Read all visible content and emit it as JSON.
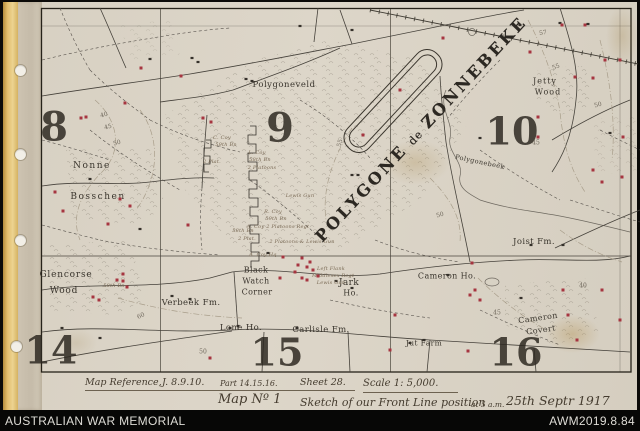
{
  "colors": {
    "post_red": "#a63540",
    "paper": "#d9d2c5",
    "ink": "#3a352d",
    "binding_yellow": "#e2bd6c"
  },
  "footer": {
    "org": "AUSTRALIAN WAR MEMORIAL",
    "id": "AWM2019.8.84"
  },
  "caption": {
    "ref_label": "Map Reference,",
    "ref_value": "J. 8.9.10.",
    "part": "Part 14.15.16.",
    "sheet": "Sheet 28.",
    "scale": "Scale 1: 5,000.",
    "map_no": "Map Nº 1",
    "title": "Sketch of our Front Line position",
    "at": "at 5 a.m.",
    "date": "25th Septr 1917"
  },
  "map": {
    "title": {
      "word1": "POLYGONE",
      "word2": "de",
      "word3": "ZONNEBEKE"
    },
    "grid_numbers": [
      {
        "t": "8",
        "x": 54,
        "y": 127,
        "s": 40
      },
      {
        "t": "9",
        "x": 280,
        "y": 128,
        "s": 40
      },
      {
        "t": "10",
        "x": 512,
        "y": 131,
        "s": 38
      },
      {
        "t": "14",
        "x": 51,
        "y": 350,
        "s": 38
      },
      {
        "t": "15",
        "x": 277,
        "y": 352,
        "s": 38
      },
      {
        "t": "16",
        "x": 516,
        "y": 352,
        "s": 38
      }
    ],
    "place_labels": [
      {
        "t": "Polygoneveld",
        "x": 284,
        "y": 85,
        "s": 8.5,
        "ls": 0.5
      },
      {
        "t": "Jetty",
        "x": 545,
        "y": 81,
        "s": 8,
        "ls": 1
      },
      {
        "t": "Wood",
        "x": 548,
        "y": 92,
        "s": 8,
        "ls": 1
      },
      {
        "t": "Nonne",
        "x": 92,
        "y": 166,
        "s": 9,
        "ls": 1.5
      },
      {
        "t": "Bosschen",
        "x": 98,
        "y": 197,
        "s": 9,
        "ls": 1.5
      },
      {
        "t": "Glencorse",
        "x": 66,
        "y": 275,
        "s": 9,
        "ls": 0.8
      },
      {
        "t": "Wood",
        "x": 64,
        "y": 291,
        "s": 9,
        "ls": 0.8
      },
      {
        "t": "Black",
        "x": 256,
        "y": 270,
        "s": 8
      },
      {
        "t": "Watch",
        "x": 256,
        "y": 281,
        "s": 8
      },
      {
        "t": "Corner",
        "x": 257,
        "y": 292,
        "s": 8
      },
      {
        "t": "Jark",
        "x": 349,
        "y": 283,
        "s": 9
      },
      {
        "t": "Ho.",
        "x": 351,
        "y": 293,
        "s": 8
      },
      {
        "t": "Verbeek Fm.",
        "x": 191,
        "y": 303,
        "s": 8.5
      },
      {
        "t": "Lone Ho.",
        "x": 241,
        "y": 328,
        "s": 8.5
      },
      {
        "t": "Carlisle Fm.",
        "x": 321,
        "y": 330,
        "s": 8.5
      },
      {
        "t": "Jut Farm",
        "x": 424,
        "y": 343,
        "s": 7.5
      },
      {
        "t": "Joist Fm.",
        "x": 534,
        "y": 242,
        "s": 8.5
      },
      {
        "t": "Cameron Ho.",
        "x": 447,
        "y": 276,
        "s": 8
      },
      {
        "t": "Cameron",
        "x": 538,
        "y": 318,
        "s": 8,
        "r": -8
      },
      {
        "t": "Covert",
        "x": 541,
        "y": 330,
        "s": 8,
        "r": -8
      },
      {
        "t": "Polygonebeek",
        "x": 480,
        "y": 162,
        "s": 6.5,
        "r": 12
      }
    ],
    "contour_labels": [
      {
        "t": "40",
        "x": 104,
        "y": 115,
        "r": -15
      },
      {
        "t": "45",
        "x": 108,
        "y": 127,
        "r": -15
      },
      {
        "t": "50",
        "x": 117,
        "y": 143,
        "r": -15
      },
      {
        "t": "57",
        "x": 543,
        "y": 33,
        "r": -10
      },
      {
        "t": "55",
        "x": 556,
        "y": 67,
        "r": -20
      },
      {
        "t": "50",
        "x": 598,
        "y": 105,
        "r": -15
      },
      {
        "t": "45",
        "x": 536,
        "y": 143
      },
      {
        "t": "55",
        "x": 340,
        "y": 143,
        "r": -75
      },
      {
        "t": "60",
        "x": 141,
        "y": 316,
        "r": -25
      },
      {
        "t": "50",
        "x": 203,
        "y": 352
      },
      {
        "t": "40",
        "x": 583,
        "y": 286
      },
      {
        "t": "45",
        "x": 497,
        "y": 313
      },
      {
        "t": "50",
        "x": 440,
        "y": 215,
        "r": -15
      }
    ],
    "annotations": [
      {
        "t": "C. Coy",
        "x": 222,
        "y": 138
      },
      {
        "t": "59th Bn",
        "x": 226,
        "y": 145
      },
      {
        "t": "L. Coy",
        "x": 257,
        "y": 153
      },
      {
        "t": "58th Bn",
        "x": 260,
        "y": 160
      },
      {
        "t": "2 Platoons",
        "x": 262,
        "y": 168
      },
      {
        "t": "2 Plat.",
        "x": 212,
        "y": 162
      },
      {
        "t": "Lewis Gun",
        "x": 300,
        "y": 196
      },
      {
        "t": "R. Coy",
        "x": 273,
        "y": 212
      },
      {
        "t": "59th Bn",
        "x": 276,
        "y": 219
      },
      {
        "t": "A. Coy  2 Platoons  Regt",
        "x": 278,
        "y": 227
      },
      {
        "t": "58th Bn",
        "x": 243,
        "y": 231
      },
      {
        "t": "2 Plat.",
        "x": 247,
        "y": 239
      },
      {
        "t": "2 Platoons & Lewis Gun",
        "x": 302,
        "y": 242
      },
      {
        "t": "A. Coy Hq",
        "x": 263,
        "y": 255
      },
      {
        "t": "Left Flank",
        "x": 331,
        "y": 269
      },
      {
        "t": "Middlesex Regt",
        "x": 333,
        "y": 276
      },
      {
        "t": "Lewis Gun",
        "x": 331,
        "y": 283
      },
      {
        "t": "58th Bn",
        "x": 114,
        "y": 286
      }
    ],
    "red_marks": [
      [
        141,
        68
      ],
      [
        181,
        76
      ],
      [
        125,
        103
      ],
      [
        81,
        118
      ],
      [
        86,
        117
      ],
      [
        203,
        118
      ],
      [
        211,
        122
      ],
      [
        55,
        192
      ],
      [
        63,
        211
      ],
      [
        120,
        199
      ],
      [
        130,
        206
      ],
      [
        108,
        224
      ],
      [
        188,
        225
      ],
      [
        562,
        25
      ],
      [
        585,
        25
      ],
      [
        530,
        52
      ],
      [
        605,
        60
      ],
      [
        620,
        60
      ],
      [
        593,
        78
      ],
      [
        575,
        77
      ],
      [
        538,
        117
      ],
      [
        538,
        137
      ],
      [
        593,
        170
      ],
      [
        602,
        182
      ],
      [
        622,
        177
      ],
      [
        623,
        137
      ],
      [
        400,
        90
      ],
      [
        443,
        38
      ],
      [
        363,
        135
      ],
      [
        283,
        257
      ],
      [
        298,
        265
      ],
      [
        307,
        267
      ],
      [
        302,
        278
      ],
      [
        307,
        280
      ],
      [
        313,
        270
      ],
      [
        280,
        278
      ],
      [
        295,
        272
      ],
      [
        310,
        262
      ],
      [
        318,
        276
      ],
      [
        302,
        258
      ],
      [
        472,
        263
      ],
      [
        475,
        290
      ],
      [
        470,
        295
      ],
      [
        480,
        300
      ],
      [
        563,
        290
      ],
      [
        568,
        315
      ],
      [
        602,
        290
      ],
      [
        577,
        340
      ],
      [
        620,
        320
      ],
      [
        395,
        315
      ],
      [
        390,
        350
      ],
      [
        468,
        351
      ],
      [
        210,
        358
      ],
      [
        93,
        297
      ],
      [
        99,
        300
      ],
      [
        123,
        274
      ],
      [
        123,
        281
      ],
      [
        127,
        287
      ],
      [
        117,
        280
      ]
    ]
  }
}
